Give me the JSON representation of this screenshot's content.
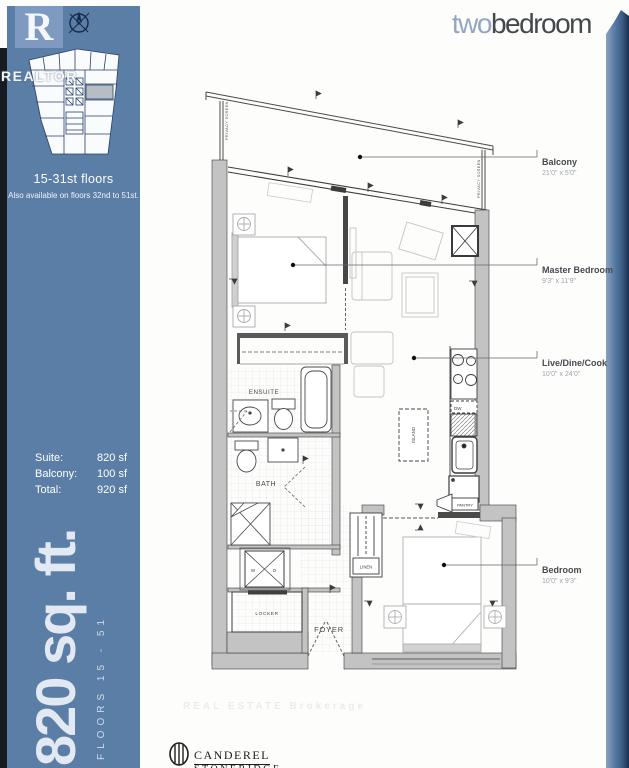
{
  "header": {
    "title_light": "two",
    "title_dark": "bedroom"
  },
  "sidebar": {
    "logo_letter": "R",
    "realtor_watermark": "REALTOR",
    "floors_heading": "15-31st floors",
    "floors_note": "Also available on floors 32nd to 51st.",
    "areas": [
      {
        "label": "Suite:",
        "value": "820 sf"
      },
      {
        "label": "Balcony:",
        "value": "100 sf"
      },
      {
        "label": "Total:",
        "value": "920 sf"
      }
    ],
    "big_text": "820 sq. ft.",
    "floors_vertical": "FLOORS 15 - 51"
  },
  "plan": {
    "labels": {
      "balcony": {
        "name": "Balcony",
        "dims": "21'0\" x 5'0\""
      },
      "master": {
        "name": "Master Bedroom",
        "dims": "9'3\" x 11'9\""
      },
      "living": {
        "name": "Live/Dine/Cook",
        "dims": "10'0\" x 24'0\""
      },
      "bedroom2": {
        "name": "Bedroom",
        "dims": "10'0\" x 9'3\""
      }
    },
    "room_labels": {
      "ensuite": "ENSUITE",
      "bath": "BATH",
      "foyer": "FOYER",
      "locker": "LOCKER",
      "linen": "LINEN",
      "pantry": "PANTRY",
      "island": "ISLAND",
      "dw": "DW",
      "washer": "W",
      "dryer": "D",
      "privacy_screen": "PRIVACY SCREEN"
    }
  },
  "footer": {
    "brand_top": "CANDEREL",
    "brand_bottom": "STONERIDGE",
    "watermark": "REAL ESTATE Brokerage"
  },
  "colors": {
    "sidebar_blue": "#5b7ea7",
    "logo_blue": "#7e9ac1",
    "title_light": "#93a7c2",
    "title_dark": "#45484d",
    "wall_gray": "#c3c3c3",
    "keyplan_navy": "#27406b"
  }
}
